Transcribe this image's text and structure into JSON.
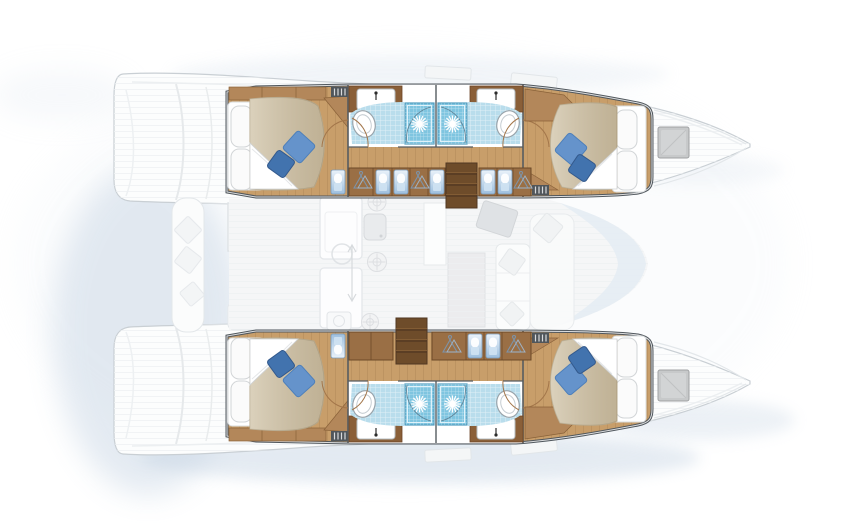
{
  "page": {
    "background": "#ffffff"
  },
  "colors": {
    "wall_outline": "#50575d",
    "wall_inner": "#ffffff",
    "wood_floor": "#c89e6a",
    "wood_cabinet": "#b3875a",
    "wood_dark": "#8a5f38",
    "steps_wood": "#6e4c2a",
    "bed_duvet": "#cfc2a6",
    "bed_sheet": "#ffffff",
    "pillow_white": "#fbfbfb",
    "pillow_blue_light": "#6593cb",
    "pillow_blue_dark": "#4273ae",
    "bath_floor": "#b9ddec",
    "shower_blue": "#7fc5e0",
    "fixture_white": "#ffffff",
    "fixture_stroke": "#9aa4ab",
    "door_arc": "#a3764a",
    "hull_faint_stroke": "#c9cfd4",
    "deck_fill": "#fcfdfd",
    "salon_faint_fill": "#f5f6f7",
    "salon_faint_stroke": "#e2e5e8",
    "windshield": "#e4ecf3",
    "hatch_gray": "#c7c9ca",
    "grille_dark": "#50565b",
    "cabinet_front_blue": "#9dbfde",
    "shadow_blue": "#c3d2e2"
  },
  "boat": {
    "view": "top-down-deck-plan",
    "hulls": [
      {
        "name": "port-hull",
        "aft_cabin": {
          "furniture": [
            "double-bed",
            "white-pillows",
            "blue-cushions",
            "wardrobe",
            "vent-grille"
          ]
        },
        "bathrooms": [
          {
            "fixtures": [
              "sink",
              "faucet",
              "toilet",
              "shower",
              "door"
            ]
          },
          {
            "fixtures": [
              "sink",
              "faucet",
              "toilet",
              "shower",
              "door"
            ]
          }
        ],
        "corridor": {
          "features": [
            "hanging-lockers",
            "blue-locker-fronts",
            "companionway-stairs"
          ]
        },
        "forward_cabin": {
          "furniture": [
            "double-bed",
            "white-pillows",
            "blue-cushions",
            "vent-grille"
          ]
        },
        "bow": {
          "features": [
            "deck-hatch"
          ]
        }
      },
      {
        "name": "starboard-hull",
        "aft_cabin": {
          "furniture": [
            "double-bed",
            "white-pillows",
            "blue-cushions",
            "wardrobe",
            "vent-grille"
          ]
        },
        "bathrooms": [
          {
            "fixtures": [
              "sink",
              "faucet",
              "toilet",
              "shower",
              "door"
            ]
          },
          {
            "fixtures": [
              "sink",
              "faucet",
              "toilet",
              "shower",
              "door"
            ]
          }
        ],
        "corridor": {
          "features": [
            "hanging-lockers",
            "blue-locker-fronts",
            "companionway-stairs"
          ]
        },
        "forward_cabin": {
          "furniture": [
            "double-bed",
            "white-pillows",
            "blue-cushions",
            "vent-grille"
          ]
        },
        "bow": {
          "features": [
            "deck-hatch"
          ]
        }
      }
    ],
    "salon": {
      "features": [
        "galley-counter",
        "galley-sink",
        "stove-burners",
        "dining-table",
        "u-shaped-sofa",
        "chart-seat",
        "windshield"
      ]
    },
    "cockpit": {
      "features": [
        "cockpit-table",
        "bench-seating",
        "cushions",
        "transom-steps"
      ]
    }
  }
}
